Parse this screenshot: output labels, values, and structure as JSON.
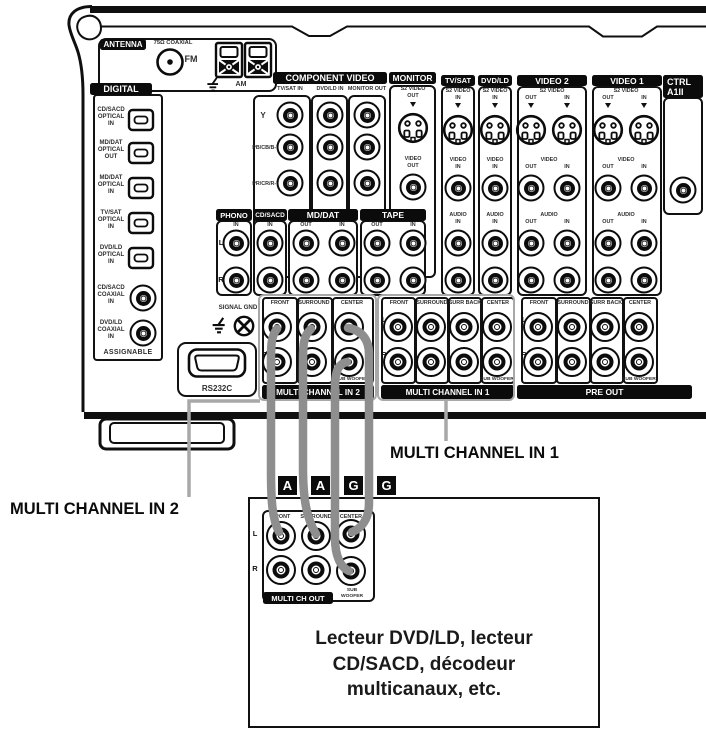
{
  "common": {
    "in": "IN",
    "out": "OUT",
    "l": "L",
    "r": "R",
    "front": "FRONT",
    "surround": "SURROUND",
    "surr_back": "SURR BACK",
    "center": "CENTER",
    "sub_woofer": "SUB WOOFER",
    "sub": "SUB",
    "woofer": "WOOFER",
    "audio": "AUDIO",
    "video": "VIDEO",
    "s2_video": "S2 VIDEO"
  },
  "antenna": {
    "title": "ANTENNA",
    "coaxial": "75Ω COAXIAL",
    "fm": "FM",
    "am": "AM"
  },
  "digital": {
    "title": "DIGITAL",
    "assignable": "ASSIGNABLE",
    "items": [
      {
        "l1": "CD/SACD",
        "l2": "OPTICAL",
        "l3": "IN"
      },
      {
        "l1": "MD/DAT",
        "l2": "OPTICAL",
        "l3": "OUT"
      },
      {
        "l1": "MD/DAT",
        "l2": "OPTICAL",
        "l3": "IN"
      },
      {
        "l1": "TV/SAT",
        "l2": "OPTICAL",
        "l3": "IN"
      },
      {
        "l1": "DVD/LD",
        "l2": "OPTICAL",
        "l3": "IN"
      },
      {
        "l1": "CD/SACD",
        "l2": "COAXIAL",
        "l3": "IN"
      },
      {
        "l1": "DVD/LD",
        "l2": "COAXIAL",
        "l3": "IN"
      }
    ]
  },
  "component_video": {
    "title": "COMPONENT VIDEO",
    "cols": [
      "TV/SAT IN",
      "DVD/LD IN",
      "MONITOR OUT"
    ],
    "rows": [
      "Y",
      "PB/CB/B-Y",
      "PR/CR/R-Y"
    ]
  },
  "monitor": {
    "title": "MONITOR"
  },
  "tvsat": {
    "title": "TV/SAT"
  },
  "dvdld": {
    "title": "DVD/LD"
  },
  "video2": {
    "title": "VIDEO 2"
  },
  "video1": {
    "title": "VIDEO 1"
  },
  "ctrl": {
    "l1": "CTRL",
    "l2": "A1II"
  },
  "phono": {
    "title": "PHONO"
  },
  "cdsacd": {
    "title": "CD/SACD"
  },
  "mddat": {
    "title": "MD/DAT"
  },
  "tape": {
    "title": "TAPE"
  },
  "signal_gnd": "SIGNAL GND",
  "rs232c": "RS232C",
  "multi_in2": {
    "title": "MULTI CHANNEL IN 2"
  },
  "multi_in1": {
    "title": "MULTI CHANNEL IN 1"
  },
  "pre_out": {
    "title": "PRE OUT"
  },
  "badges": [
    "A",
    "A",
    "G",
    "G"
  ],
  "callouts": {
    "in1": "MULTI CHANNEL IN 1",
    "in2": "MULTI CHANNEL IN 2"
  },
  "device": {
    "multi_ch_out": "MULTI CH OUT",
    "caption_l1": "Lecteur DVD/LD, lecteur",
    "caption_l2": "CD/SACD, décodeur",
    "caption_l3": "multicanaux, etc."
  },
  "colors": {
    "ink": "#111111",
    "cable_gray": "#8e8e8e",
    "callout_gray": "#a8a8a8"
  }
}
